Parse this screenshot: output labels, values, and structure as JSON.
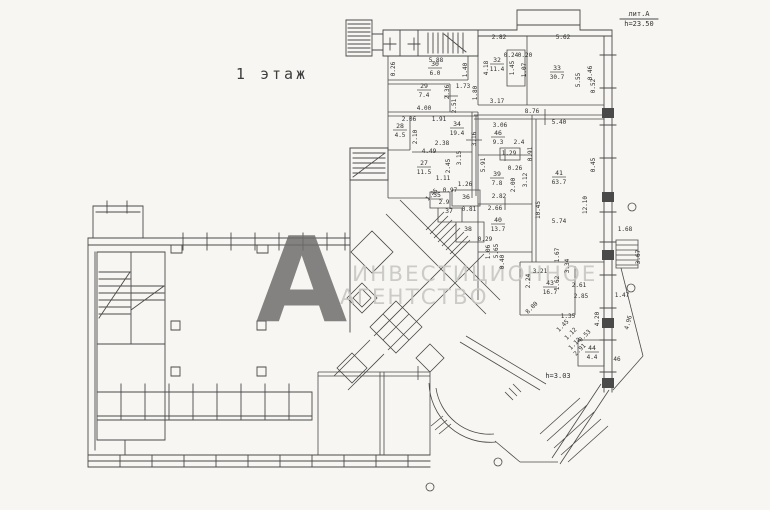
{
  "header": {
    "floor_title": "1 этаж",
    "lit_label": "лит.А",
    "lit_height": "h=23.50"
  },
  "watermark": {
    "logo_letter": "А",
    "line1": "ИНВЕСТИЦИОННОЕ",
    "line2": "АГЕНТСТВО"
  },
  "annotations": {
    "entry_height": "h=3.03"
  },
  "colors": {
    "paper": "#f7f6f2",
    "line": "#4a4a4a",
    "watermark_text": "#c7c6c3",
    "watermark_logo": "#6e6d6b"
  },
  "rooms": [
    {
      "num": "30",
      "area": "6.0"
    },
    {
      "num": "29",
      "area": "7.4"
    },
    {
      "num": "28",
      "area": "4.5"
    },
    {
      "num": "34",
      "area": "19.4"
    },
    {
      "num": "32",
      "area": "11.4"
    },
    {
      "num": "33",
      "area": "30.7"
    },
    {
      "num": "27",
      "area": "11.5"
    },
    {
      "num": "46",
      "area": "9.3"
    },
    {
      "num": "39",
      "area": "7.8"
    },
    {
      "num": "41",
      "area": "63.7"
    },
    {
      "num": "40",
      "area": "13.7"
    },
    {
      "num": "43",
      "area": "16.7"
    },
    {
      "num": "35",
      "area": "2.9"
    },
    {
      "num": "36",
      "area": ""
    },
    {
      "num": "37",
      "area": ""
    },
    {
      "num": "38",
      "area": ""
    },
    {
      "num": "44",
      "area": "4.4"
    }
  ],
  "dim_labels": [
    "2.82",
    "5.62",
    "0.24",
    "0.20",
    "4.18",
    "1.45",
    "1.07",
    "5.55",
    "0.46",
    "0.52",
    "3.17",
    "8.76",
    "1.80",
    "5.88",
    "0.26",
    "1.40",
    "1.73",
    "4.00",
    "2.06",
    "1.91",
    "2.36",
    "2.51",
    "2.10",
    "2.38",
    "3.16",
    "4.49",
    "3.15",
    "2.45",
    "1.11",
    "0.97",
    "1.26",
    "1.45",
    "0.81",
    "3.06",
    "5.40",
    "2.4",
    "5.91",
    "1.29",
    "0.91",
    "0.26",
    "2.00",
    "3.12",
    "2.82",
    "2.66",
    "10.45",
    "12.10",
    "5.74",
    "0.45",
    "1.68",
    "3.67",
    "1.47",
    "4.96",
    "46",
    "0.29",
    "1.06",
    "5.65",
    "0.40",
    "1.67",
    "3.34",
    "3.21",
    "2.24",
    "1.62",
    "2.61",
    "2.85",
    "4.20",
    "1.35",
    "1.45",
    "1.12",
    "0.53",
    "1.12",
    "2.91",
    "8.00"
  ]
}
